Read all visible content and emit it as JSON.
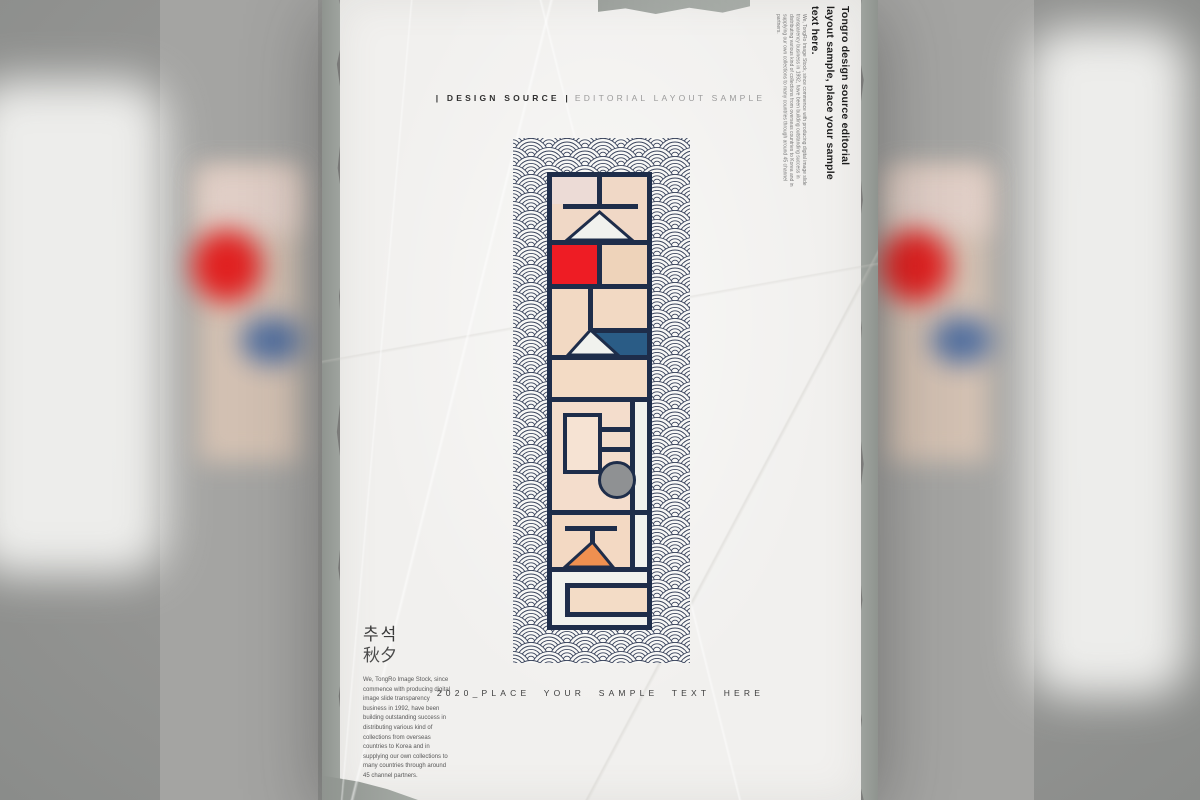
{
  "header": {
    "primary": "| DESIGN SOURCE |",
    "secondary": "EDITORIAL LAYOUT SAMPLE"
  },
  "side_caption": {
    "heading": "Tongro design source editorial layout sample, place your sample text here.",
    "body": "We, TongRo Image Stock, since commence with producing digital image slide transparency business in 1992, have been building outstanding success in distributing various kind of collections from overseas countries to Korea and in supplying our own collections to many countries through around 45 channel partners."
  },
  "left_caption": {
    "title_korean": "추석",
    "title_hanja": "秋夕",
    "body": "We, TongRo Image Stock, since commence with producing digital image slide transparency business in 1992, have been building outstanding success in distributing various kind of collections from overseas countries to Korea and in supplying our own collections to many countries through around 45 channel partners."
  },
  "footer": {
    "text": "2020_PLACE YOUR SAMPLE TEXT HERE"
  },
  "artwork": {
    "word": "추석명절",
    "style": "geometric Hangul typography over seigaiha wave pattern",
    "colors": {
      "navy": "#1e2d4a",
      "wave_line": "#39435c",
      "red": "#ee1c24",
      "steel_blue": "#2a5c86",
      "orange": "#ef9050",
      "grey_circle": "#8f9193",
      "peach": "#f2d9c3",
      "peach_light": "#ecdbd6",
      "peach_deep": "#eed3ba",
      "white_shape": "#f1f2ee"
    }
  },
  "scene": {
    "paper_color": "#f1f0ee",
    "background_grey": "#979795",
    "torn_edge_grey": "#9aa09b"
  }
}
